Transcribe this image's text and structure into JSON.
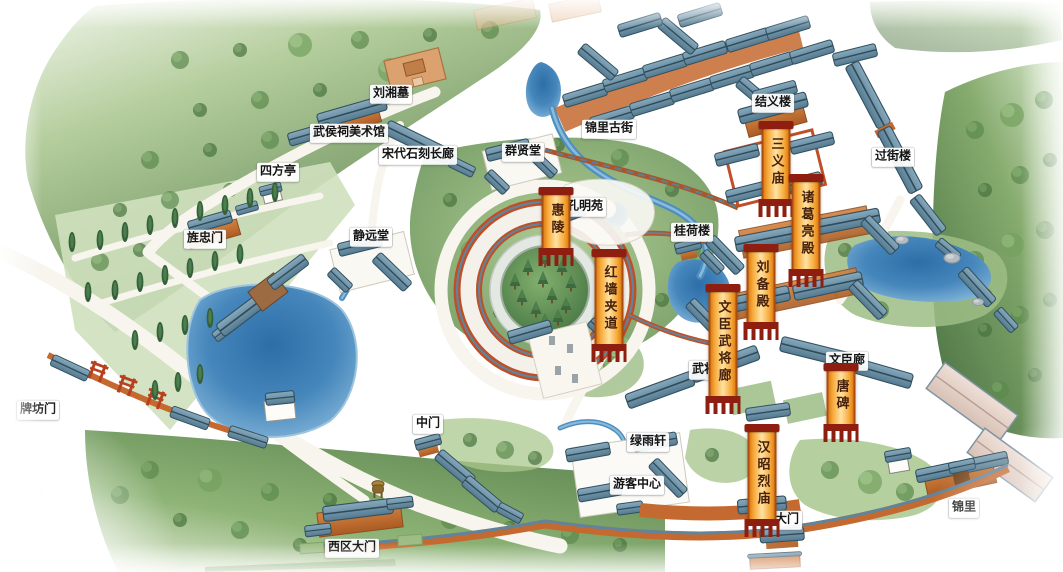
{
  "map": {
    "colors": {
      "banner_orange": "#e07d15",
      "banner_cap_red": "#8e1f10",
      "banner_text": "#47200a",
      "label_bg": "#ffffff",
      "label_text": "#141414",
      "water": "#4586bb",
      "forest_green": "#6d965c",
      "roof_blue": "#5b82a0",
      "wall_orange": "#c4692f",
      "red_wall": "#bf4f28"
    },
    "labels": [
      {
        "id": "liuxiang-tomb",
        "text": "刘湘墓",
        "type": "plain",
        "x": 391,
        "y": 94
      },
      {
        "id": "art-museum",
        "text": "武侯祠美术馆",
        "type": "plain",
        "x": 349,
        "y": 133
      },
      {
        "id": "song-stone-corridor",
        "text": "宋代石刻长廊",
        "type": "plain",
        "x": 418,
        "y": 155
      },
      {
        "id": "sifang-pavilion",
        "text": "四方亭",
        "type": "plain",
        "x": 278,
        "y": 172
      },
      {
        "id": "jingzhong-gate",
        "text": "旌忠门",
        "type": "plain",
        "x": 205,
        "y": 239
      },
      {
        "id": "jingyuan-hall",
        "text": "静远堂",
        "type": "plain",
        "x": 371,
        "y": 237
      },
      {
        "id": "qunxian-hall",
        "text": "群贤堂",
        "type": "plain",
        "x": 523,
        "y": 152
      },
      {
        "id": "jinli-old-street",
        "text": "锦里古街",
        "type": "plain",
        "x": 609,
        "y": 129
      },
      {
        "id": "jieyi-tower",
        "text": "结义楼",
        "type": "plain",
        "x": 773,
        "y": 103
      },
      {
        "id": "guojie-tower",
        "text": "过街楼",
        "type": "plain",
        "x": 893,
        "y": 157
      },
      {
        "id": "kongming-garden",
        "text": "孔明苑",
        "type": "plain",
        "x": 585,
        "y": 207
      },
      {
        "id": "guihe-tower",
        "text": "桂荷楼",
        "type": "plain",
        "x": 692,
        "y": 232
      },
      {
        "id": "paifang-gate",
        "text": "牌坊门",
        "type": "plain",
        "x": 38,
        "y": 410
      },
      {
        "id": "middle-gate",
        "text": "中门",
        "type": "plain",
        "x": 428,
        "y": 424
      },
      {
        "id": "west-district-gate",
        "text": "西区大门",
        "type": "plain",
        "x": 352,
        "y": 548
      },
      {
        "id": "wujiang-corridor",
        "text": "武将廊",
        "type": "plain",
        "x": 710,
        "y": 370
      },
      {
        "id": "wenchen-corridor",
        "text": "文臣廊",
        "type": "plain",
        "x": 847,
        "y": 361
      },
      {
        "id": "lvyu-pavilion",
        "text": "绿雨轩",
        "type": "plain",
        "x": 648,
        "y": 442
      },
      {
        "id": "visitor-center",
        "text": "游客中心",
        "type": "plain",
        "x": 637,
        "y": 485
      },
      {
        "id": "main-gate",
        "text": "大门",
        "type": "plain",
        "x": 787,
        "y": 520
      },
      {
        "id": "jinli",
        "text": "锦里",
        "type": "plain",
        "x": 964,
        "y": 508
      },
      {
        "id": "huiling-tomb",
        "text": "惠陵",
        "type": "banner",
        "x": 556,
        "y": 194
      },
      {
        "id": "red-wall-lane",
        "text": "红墙夹道",
        "type": "banner",
        "x": 609,
        "y": 256
      },
      {
        "id": "sanyi-temple",
        "text": "三义庙",
        "type": "banner",
        "x": 776,
        "y": 128
      },
      {
        "id": "zhuge-liang-hall",
        "text": "诸葛亮殿",
        "type": "banner",
        "x": 806,
        "y": 181
      },
      {
        "id": "liubei-hall",
        "text": "刘备殿",
        "type": "banner",
        "x": 761,
        "y": 251
      },
      {
        "id": "wenchen-wujiang-corridor",
        "text": "文臣武将廊",
        "type": "banner",
        "x": 723,
        "y": 291
      },
      {
        "id": "tang-stele",
        "text": "唐碑",
        "type": "banner",
        "x": 841,
        "y": 370
      },
      {
        "id": "hanzhaolie-temple",
        "text": "汉昭烈庙",
        "type": "banner",
        "x": 762,
        "y": 431
      }
    ]
  }
}
